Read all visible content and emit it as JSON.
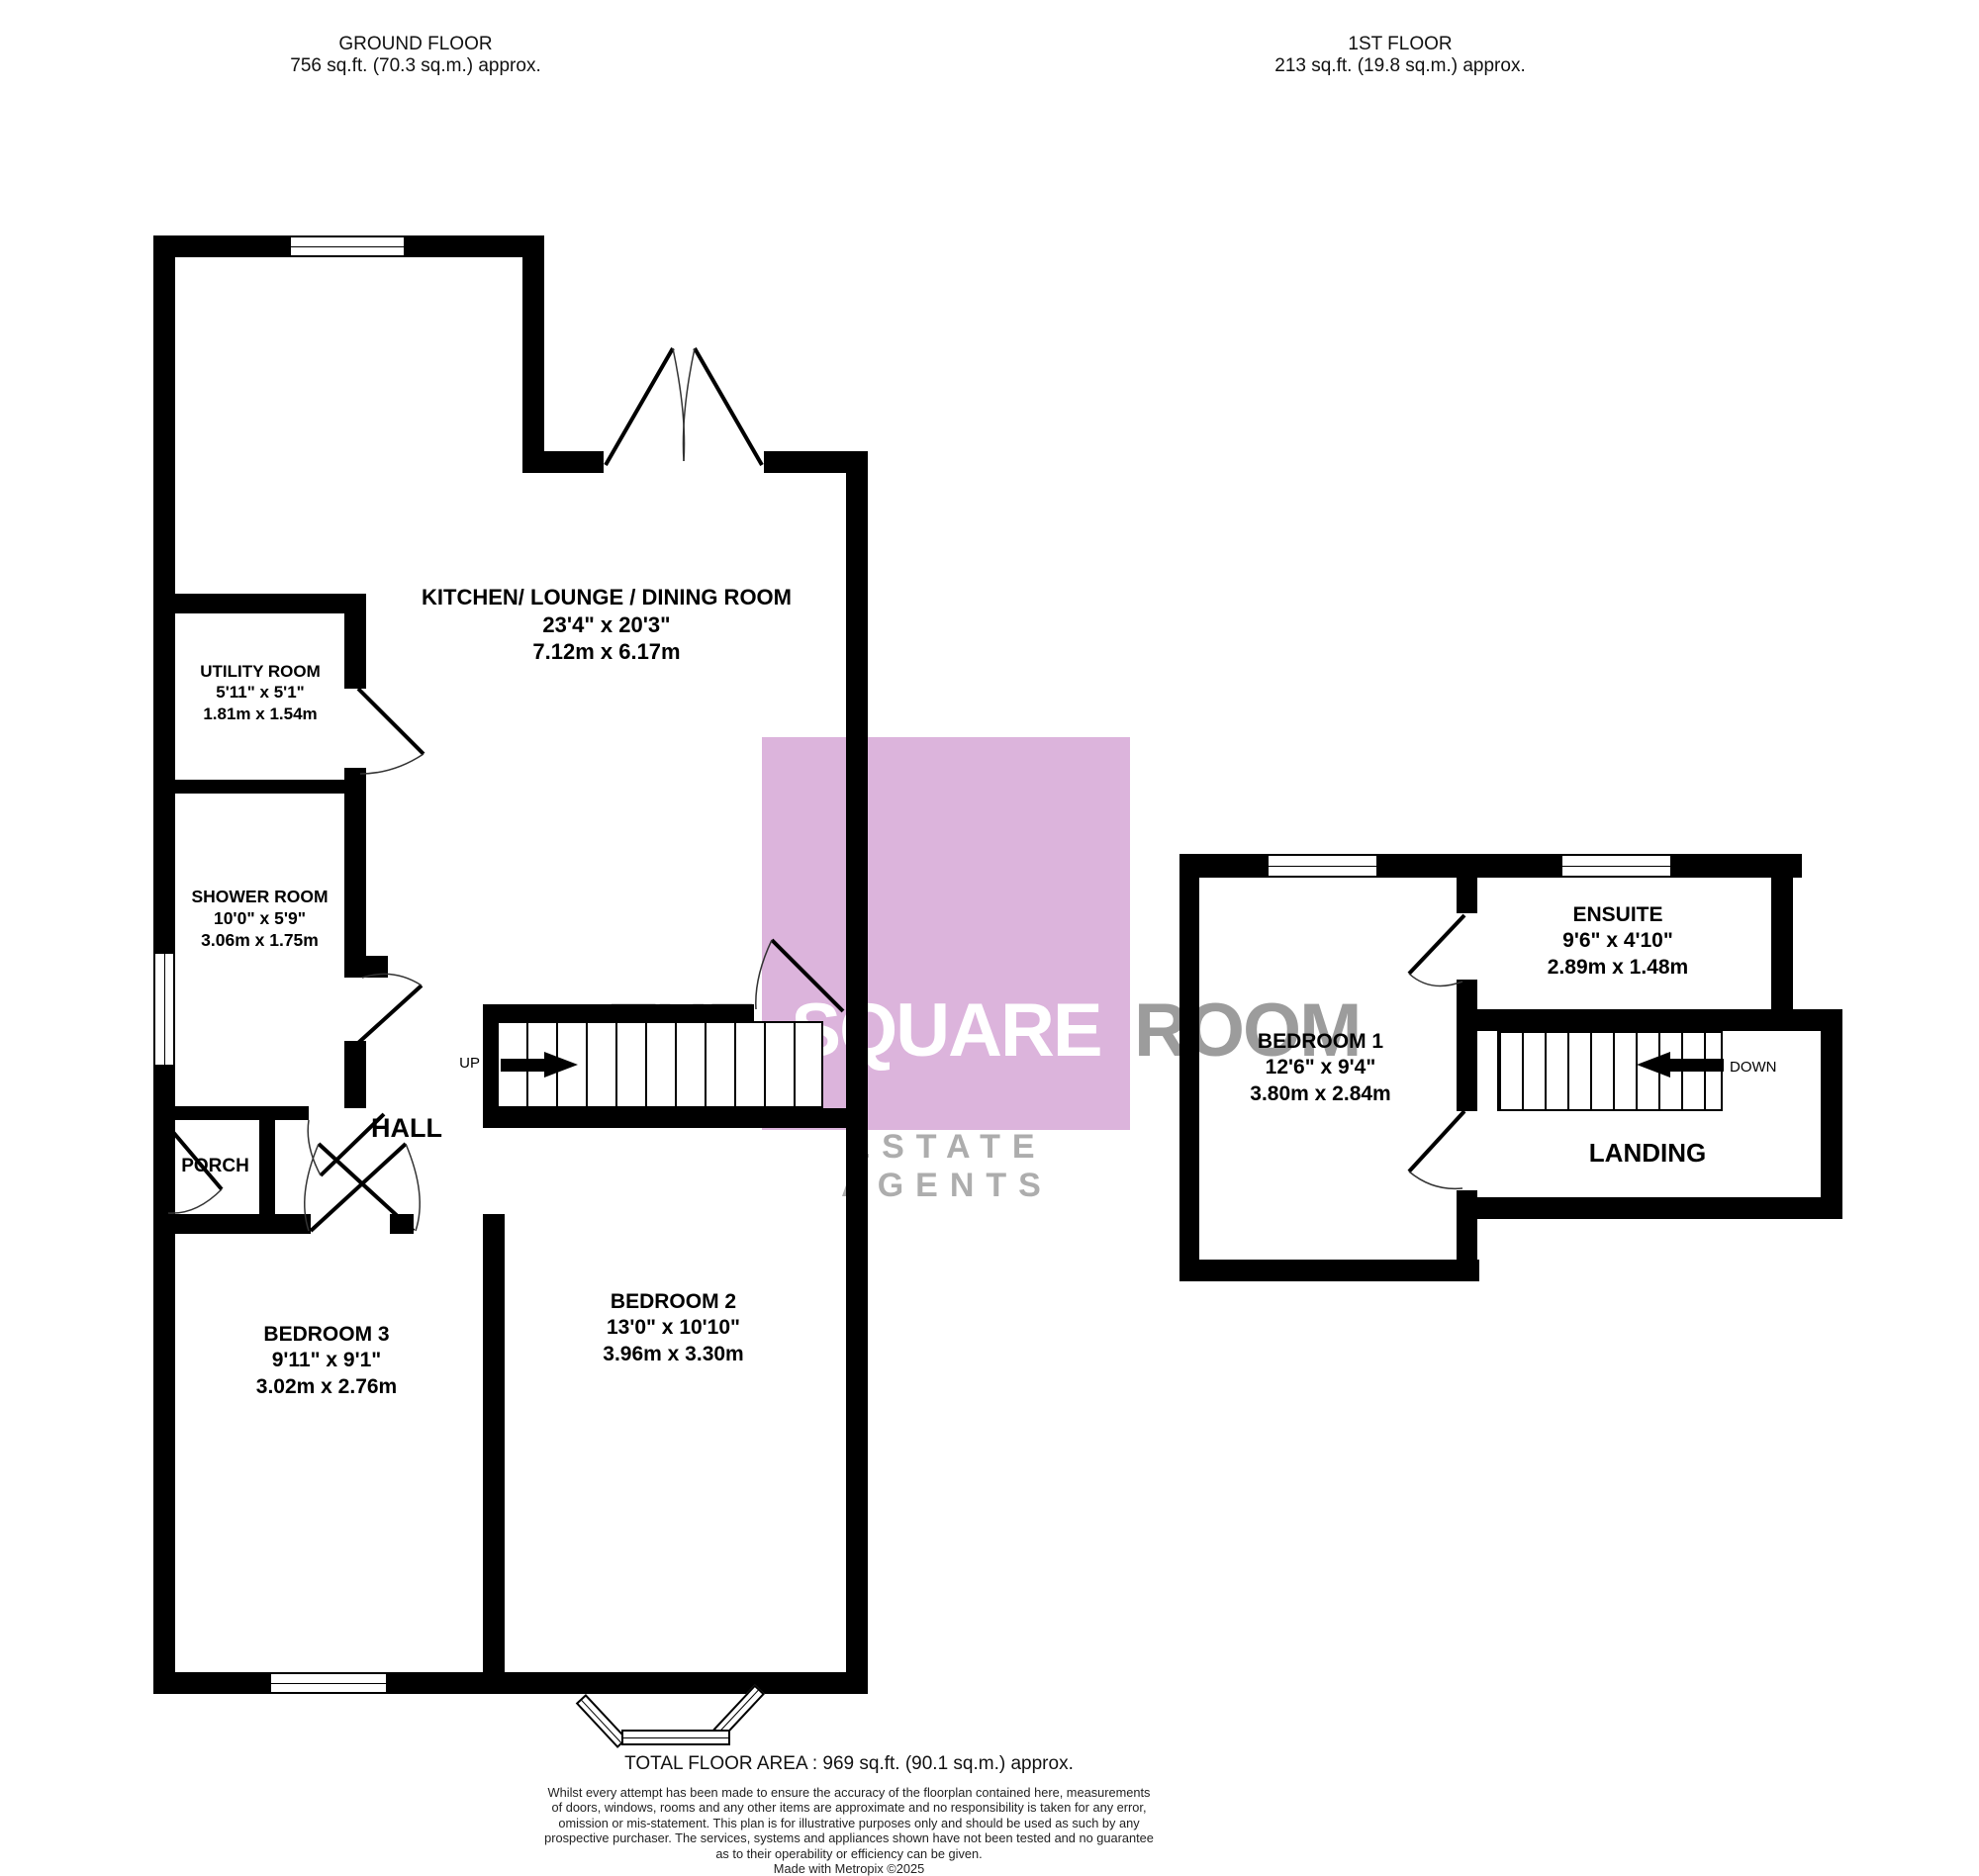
{
  "headers": {
    "ground": {
      "title": "GROUND FLOOR",
      "area": "756 sq.ft. (70.3 sq.m.) approx."
    },
    "first": {
      "title": "1ST FLOOR",
      "area": "213 sq.ft. (19.8 sq.m.) approx."
    }
  },
  "rooms": {
    "kitchen": {
      "name": "KITCHEN/ LOUNGE / DINING ROOM",
      "imperial": "23'4\"  x 20'3\"",
      "metric": "7.12m  x 6.17m"
    },
    "utility": {
      "name": "UTILITY ROOM",
      "imperial": "5'11\"  x 5'1\"",
      "metric": "1.81m  x 1.54m"
    },
    "shower": {
      "name": "SHOWER ROOM",
      "imperial": "10'0\"  x 5'9\"",
      "metric": "3.06m  x 1.75m"
    },
    "hall": {
      "name": "HALL"
    },
    "porch": {
      "name": "PORCH"
    },
    "bed3": {
      "name": "BEDROOM 3",
      "imperial": "9'11\"  x 9'1\"",
      "metric": "3.02m  x 2.76m"
    },
    "bed2": {
      "name": "BEDROOM 2",
      "imperial": "13'0\"  x 10'10\"",
      "metric": "3.96m  x 3.30m"
    },
    "bed1": {
      "name": "BEDROOM 1",
      "imperial": "12'6\"  x 9'4\"",
      "metric": "3.80m  x 2.84m"
    },
    "ensuite": {
      "name": "ENSUITE",
      "imperial": "9'6\"  x 4'10\"",
      "metric": "2.89m  x 1.48m"
    },
    "landing": {
      "name": "LANDING"
    }
  },
  "stairs": {
    "ground": {
      "label": "UP"
    },
    "first": {
      "label": "DOWN"
    }
  },
  "watermark": {
    "word_left": "THE",
    "word_mid": "SQUARE",
    "word_right": "ROOM",
    "tagline": "ESTATE AGENTS"
  },
  "footer": {
    "total": "TOTAL FLOOR AREA : 969 sq.ft. (90.1 sq.m.) approx.",
    "disclaimer_lines": [
      "Whilst every attempt has been made to ensure the accuracy of the floorplan contained here, measurements",
      "of doors, windows, rooms and any other items are approximate and no responsibility is taken for any error,",
      "omission or mis-statement. This plan is for illustrative purposes only and should be used as such by any",
      "prospective purchaser. The services, systems and appliances shown have not been tested and no guarantee",
      "as to their operability or efficiency can be given."
    ],
    "credit": "Made with Metropix ©2025"
  },
  "colors": {
    "wall": "#000000",
    "watermark_pink": "#DCB4DC",
    "watermark_gray": "#9C9C9C",
    "watermark_light_gray": "#ADADAD"
  }
}
